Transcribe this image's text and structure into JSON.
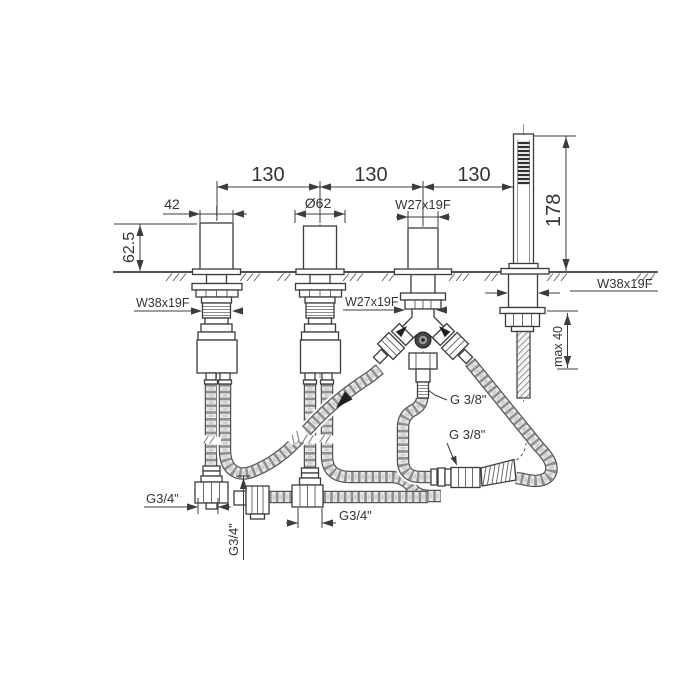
{
  "colors": {
    "line": "#3c3c3c",
    "text": "#333333",
    "hose_outline": "#565656",
    "hose_fill": "#e7e7e7",
    "braid": "#8f8f8f",
    "background": "#ffffff"
  },
  "dimensions": {
    "hole_spacing": [
      "130",
      "130",
      "130"
    ],
    "handle_width": "42",
    "spout_base_diameter": "Ø62",
    "diverter_thread": "W27x19F",
    "body_height": "62.5",
    "handshower_height": "178",
    "valve_shank_thread": "W38x19F",
    "diverter_shank_thread": "W27x19F",
    "handshower_shank_thread": "W38x19F",
    "max_deck_thickness": "max 40",
    "diverter_outlet_thread": "G 3/8\"",
    "shower_hose_thread": "G 3/8\"",
    "supply_connection_left": "G3/4\"",
    "supply_connection_center": "G3/4\"",
    "supply_connection_right": "G3/4\""
  }
}
